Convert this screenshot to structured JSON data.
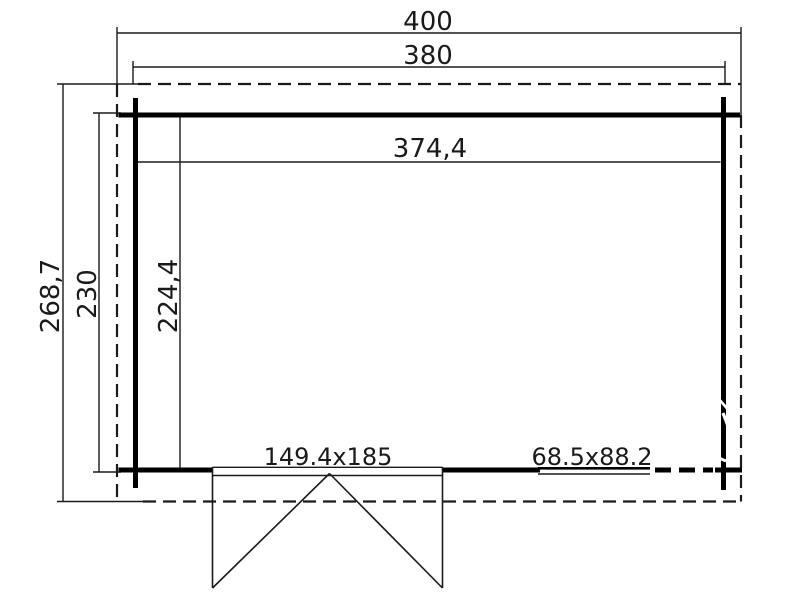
{
  "page": {
    "background_color": "#ffffff",
    "line_color": "#000000"
  },
  "plan": {
    "top_dimensions": {
      "overall_width": "400",
      "wall_width": "380"
    },
    "left_dimensions": {
      "overall_depth": "268,7",
      "wall_depth": "230",
      "interior_depth": "224,4"
    },
    "interior_dimensions": {
      "interior_width": "374,4"
    },
    "openings": {
      "door_label": "149.4x185",
      "window_label": "68.5x88.2"
    }
  }
}
